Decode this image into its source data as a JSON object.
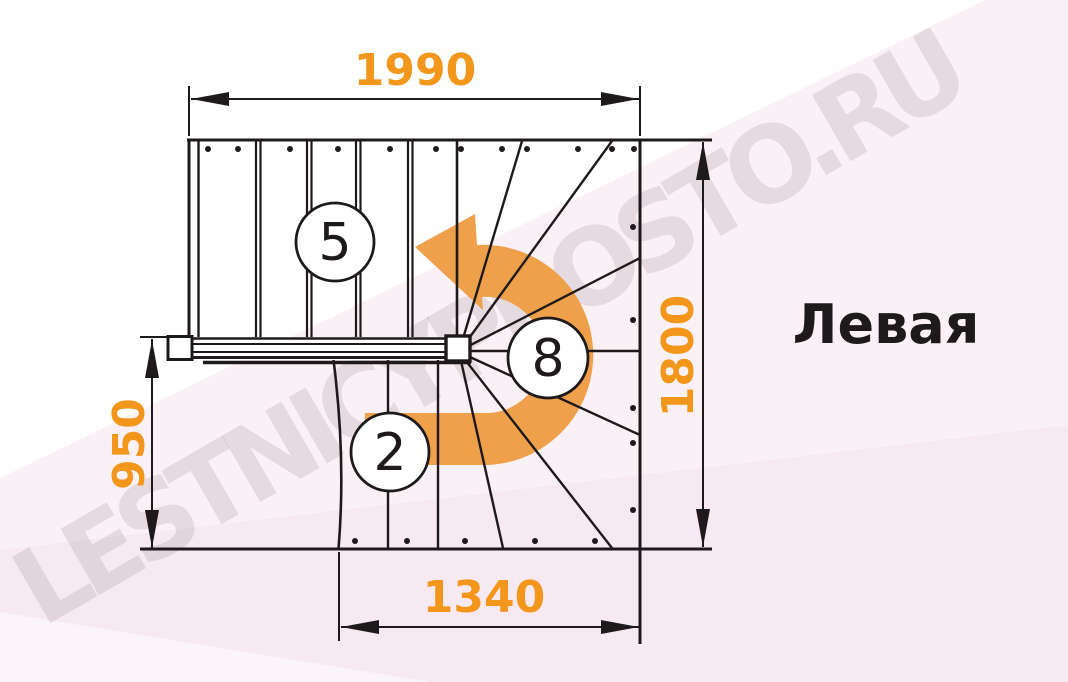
{
  "side_label": {
    "text": "Левая"
  },
  "watermark": {
    "text": "LESTNICYPROSTO.RU"
  },
  "dimensions": {
    "top": "1990",
    "right": "1800",
    "left": "950",
    "bottom": "1340"
  },
  "step_markers": {
    "upper_flight": "5",
    "winder": "8",
    "lower_flight": "2"
  },
  "colors": {
    "dimension_text_orange": "#F2971B",
    "arrow_orange": "#EFA04B",
    "drawing_line_black": "#1E1A1B",
    "background_pink": "#F2DEEB",
    "watermark_gray": "#E6E2E5"
  }
}
